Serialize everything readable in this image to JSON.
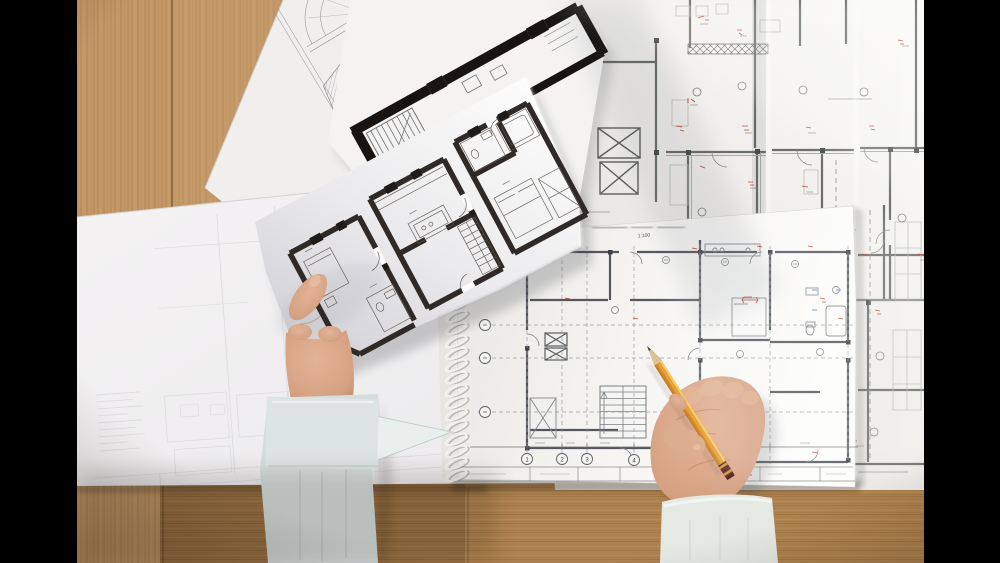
{
  "scene": {
    "alt": "Top-down photo of an architect's desk: a left hand holds a floor-plan sheet and a right hand draws with a pencil over blueprints, a spiral notebook and a large technical drawing on a wooden table"
  },
  "colors": {
    "letterbox": "#000000",
    "wood": "#c39766",
    "wood_dark_plank": "#9c713f",
    "paper_white": "#fbfbfb",
    "tracing_paper": "#f2f0f1",
    "blueprint_ink": "#676b66",
    "wall_ink": "#17120f",
    "annotation_red": "#b23a2c",
    "annotation_blue": "#6b8fc0",
    "pencil_body": "#eda93c",
    "pencil_ferrule": "#5f201c",
    "skin": "#d9a88b",
    "sleeve_left": "#d6dedd",
    "sleeve_right": "#e5e9e4"
  },
  "notebook": {
    "scale_label": "1:100",
    "grid_bubbles": [
      "1",
      "2",
      "3",
      "4"
    ]
  }
}
